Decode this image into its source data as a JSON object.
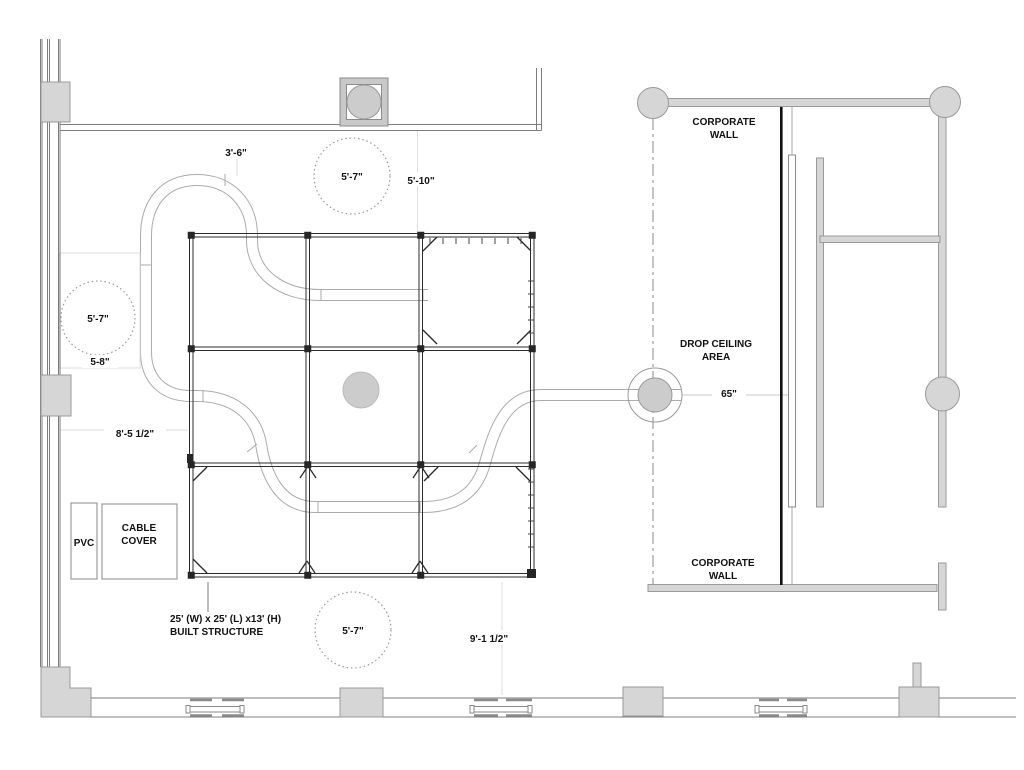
{
  "labels": {
    "dim_top_offset": "3'-6\"",
    "dim_circle_top": "5'-7\"",
    "dim_top_right": "5'-10\"",
    "dim_circle_left": "5'-7\"",
    "dim_left_small": "5-8\"",
    "dim_left_long": "8'-5 1/2\"",
    "pvc": "PVC",
    "cable_cover_line1": "CABLE",
    "cable_cover_line2": "COVER",
    "built_line1": "25' (W) x 25' (L) x13' (H)",
    "built_line2": "BUILT STRUCTURE",
    "dim_circle_bottom": "5'-7\"",
    "dim_bottom_right": "9'-1 1/2\"",
    "corporate_wall_top_line1": "CORPORATE",
    "corporate_wall_top_line2": "WALL",
    "drop_ceiling_line1": "DROP CEILING",
    "drop_ceiling_line2": "AREA",
    "dim_drop_ceiling": "65\"",
    "corporate_wall_bottom_line1": "CORPORATE",
    "corporate_wall_bottom_line2": "WALL"
  },
  "colors": {
    "background": "#ffffff",
    "wall_fill": "#d6d6d6",
    "wall_stroke": "#9a9a9a",
    "structure_line": "#2b2b2b",
    "tube_line": "#ababab",
    "corporate_wall_line": "#111111",
    "faint_dimension_line": "#dcdcdc",
    "text": "#111111"
  }
}
